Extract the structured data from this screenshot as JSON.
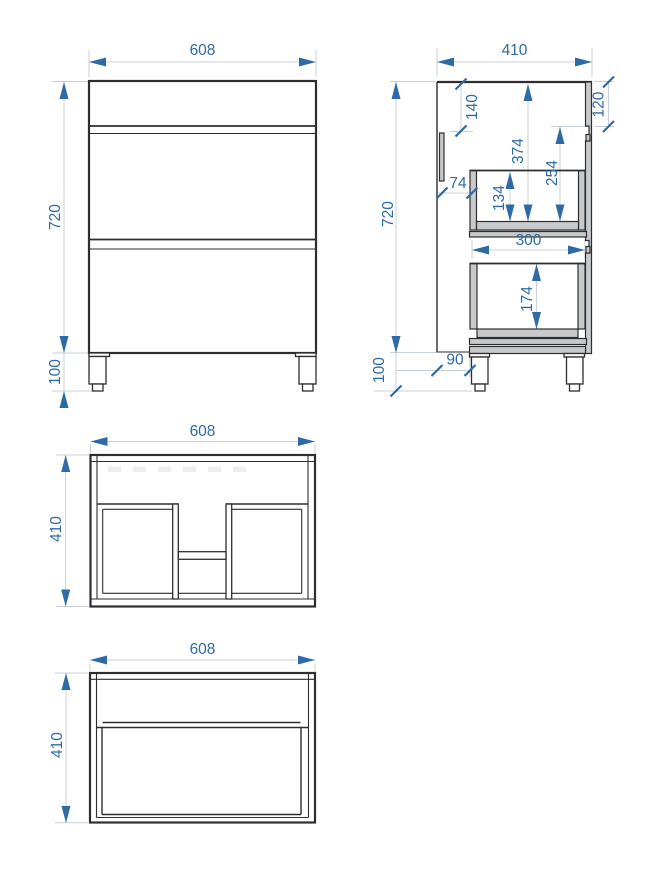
{
  "drawing": {
    "type": "cabinet-technical-drawing",
    "views": {
      "front": {
        "name": "front elevation",
        "dims": {
          "width": "608",
          "height": "720",
          "leg_height": "100"
        }
      },
      "side": {
        "name": "side section",
        "dims": {
          "depth": "410",
          "height": "720",
          "leg_height": "100",
          "top_front_height": "120",
          "back_top_offset": "140",
          "top_to_drawer1_bottom": "374",
          "groove_to_drawer1_bottom": "254",
          "drawer1_inner_height": "134",
          "back_to_drawer1": "74",
          "drawer2_depth": "300",
          "drawer2_inner_height": "174",
          "back_to_bottom_panel": "90"
        }
      },
      "plan": {
        "name": "plan view",
        "dims": {
          "width": "608",
          "depth": "410"
        }
      },
      "bottom": {
        "name": "bottom view",
        "dims": {
          "width": "608",
          "depth": "410"
        }
      }
    },
    "colors": {
      "dimension_accent": "#2e6ba6",
      "dimension_line": "#c8d1da",
      "outline": "#2e2e2e",
      "panel_fill": "#c8c9ca",
      "background": "#ffffff"
    }
  }
}
